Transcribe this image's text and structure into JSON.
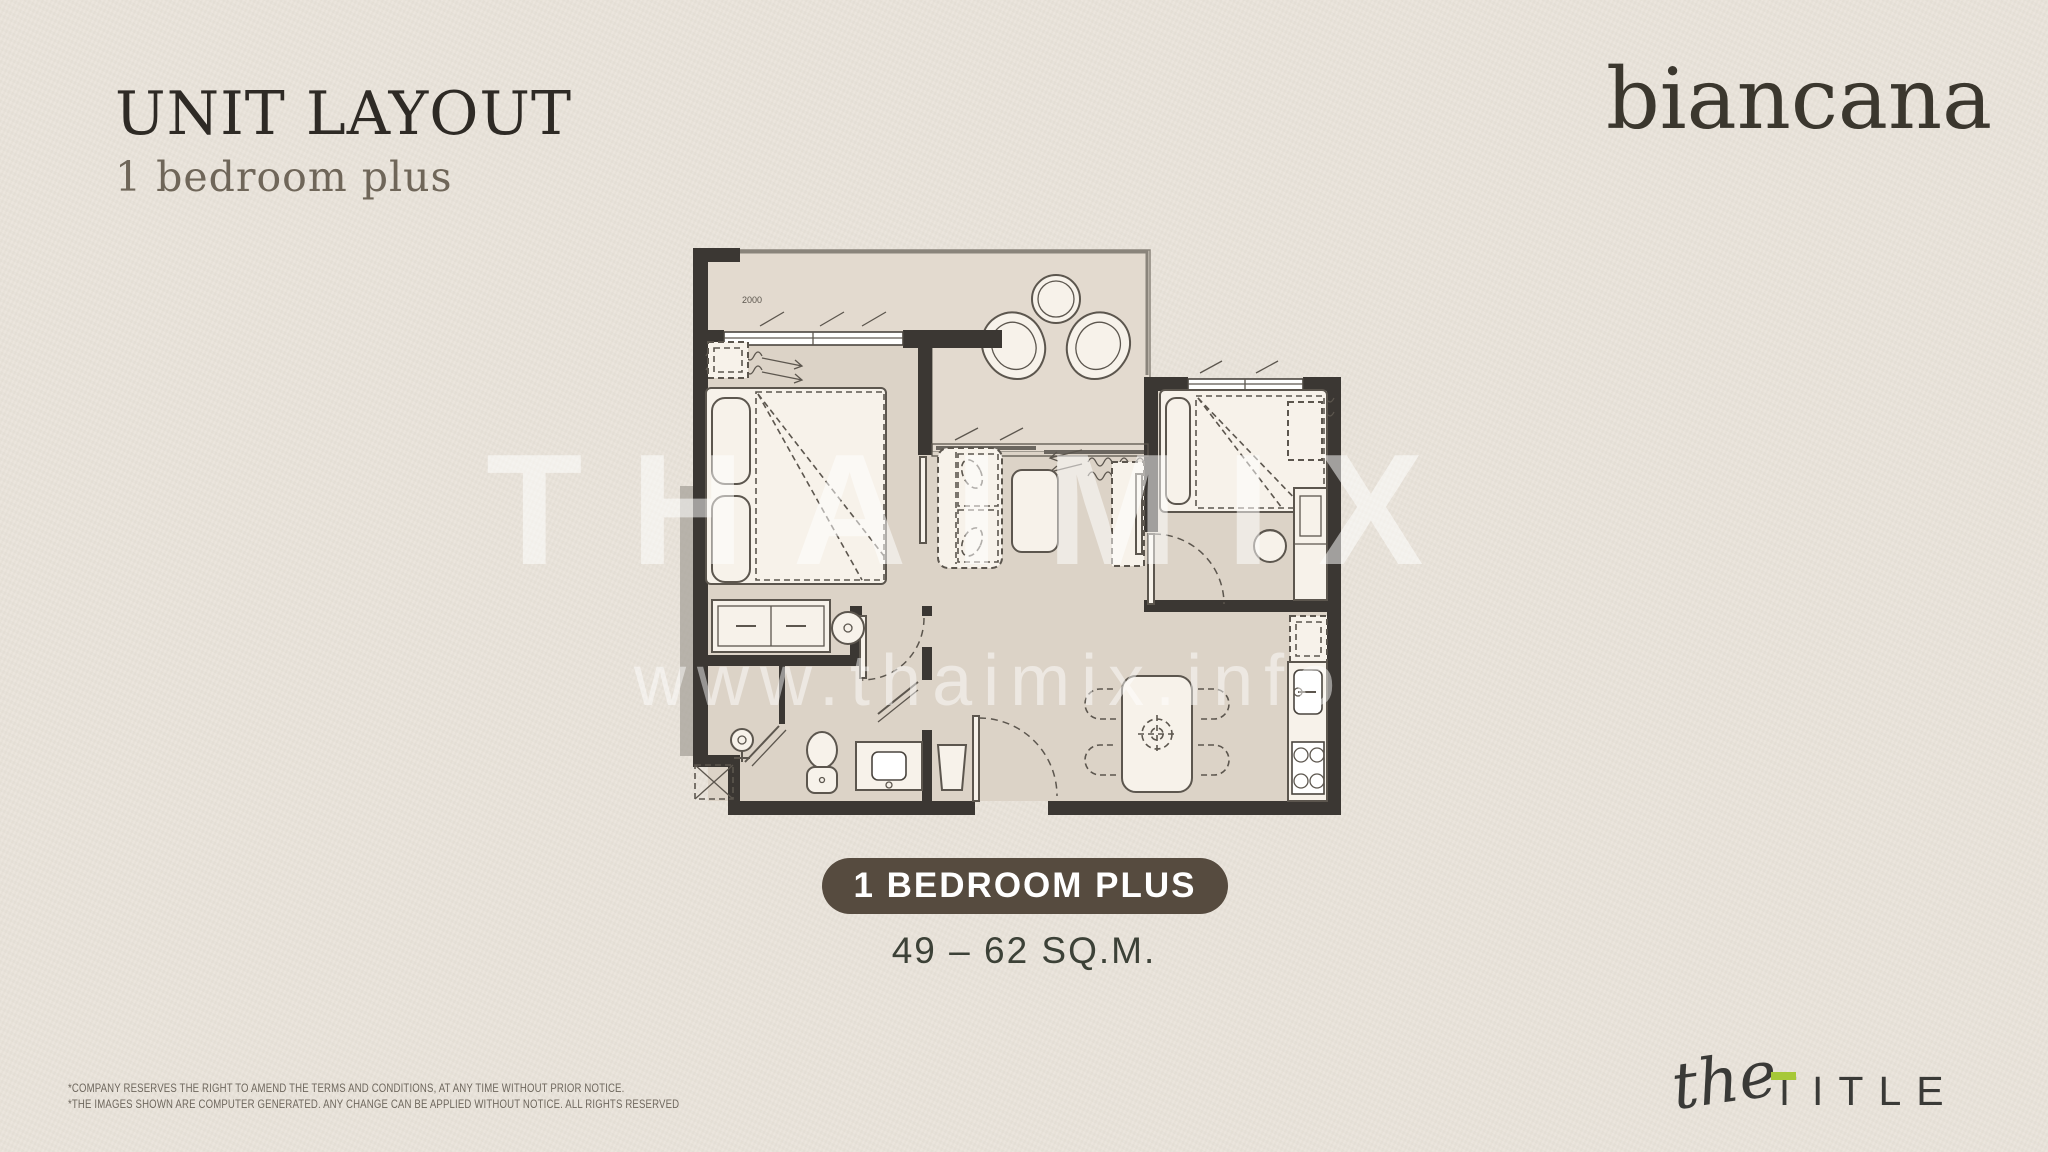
{
  "header": {
    "title": "UNIT LAYOUT",
    "subtitle": "1 bedroom plus"
  },
  "brand": {
    "name": "biancana"
  },
  "watermark": {
    "title": "THAIMIX",
    "url": "www.thaimix.info"
  },
  "floorplan": {
    "dimension_label": "2000"
  },
  "unit": {
    "type_badge": "1 BEDROOM PLUS",
    "area": "49 – 62 SQ.M."
  },
  "footer": {
    "disclaimers": [
      "*COMPANY RESERVES THE RIGHT TO AMEND THE TERMS AND CONDITIONS, AT ANY TIME WITHOUT PRIOR NOTICE.",
      "*THE IMAGES SHOWN ARE COMPUTER GENERATED. ANY CHANGE CAN BE APPLIED WITHOUT NOTICE. ALL RIGHTS RESERVED"
    ],
    "developer": {
      "script": "the",
      "caps": "TITLE"
    }
  },
  "colors": {
    "background": "#e9e3da",
    "wall": "#3b3733",
    "floor": "#dcd3c7",
    "balcony_floor": "#e3dacf",
    "furniture_fill": "#f7f2ea",
    "badge_background": "#564b3f",
    "badge_text": "#ffffff",
    "area_text": "#3c4137",
    "accent_green": "#a6c838",
    "watermark": "rgba(255,255,255,0.5)"
  }
}
